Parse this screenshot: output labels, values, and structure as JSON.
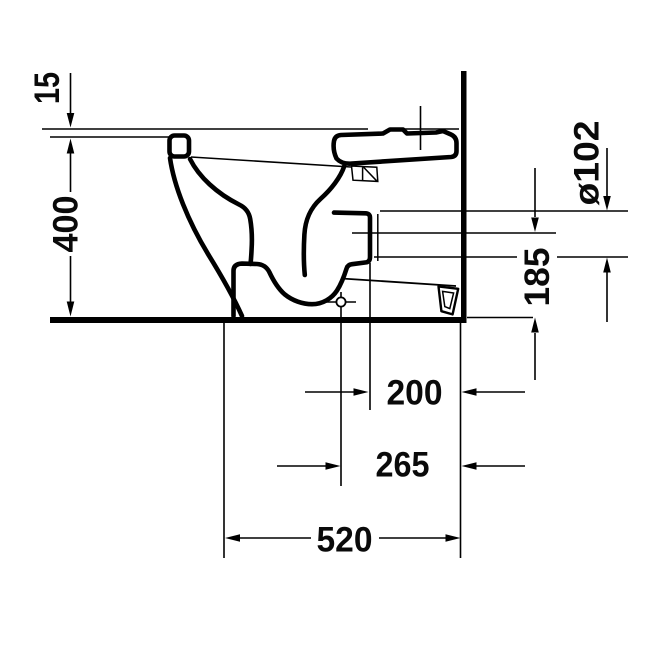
{
  "drawing": {
    "background": "#ffffff",
    "ink": "#000000",
    "subject": "toilet-side-section-dimension-drawing",
    "dimension_labels": {
      "seat_offset": "15",
      "rim_height": "400",
      "outlet_diameter": "ø102",
      "outlet_center_height": "185",
      "outlet_to_wall": "200",
      "drain_center_to_wall": "265",
      "overall_depth": "520"
    }
  }
}
